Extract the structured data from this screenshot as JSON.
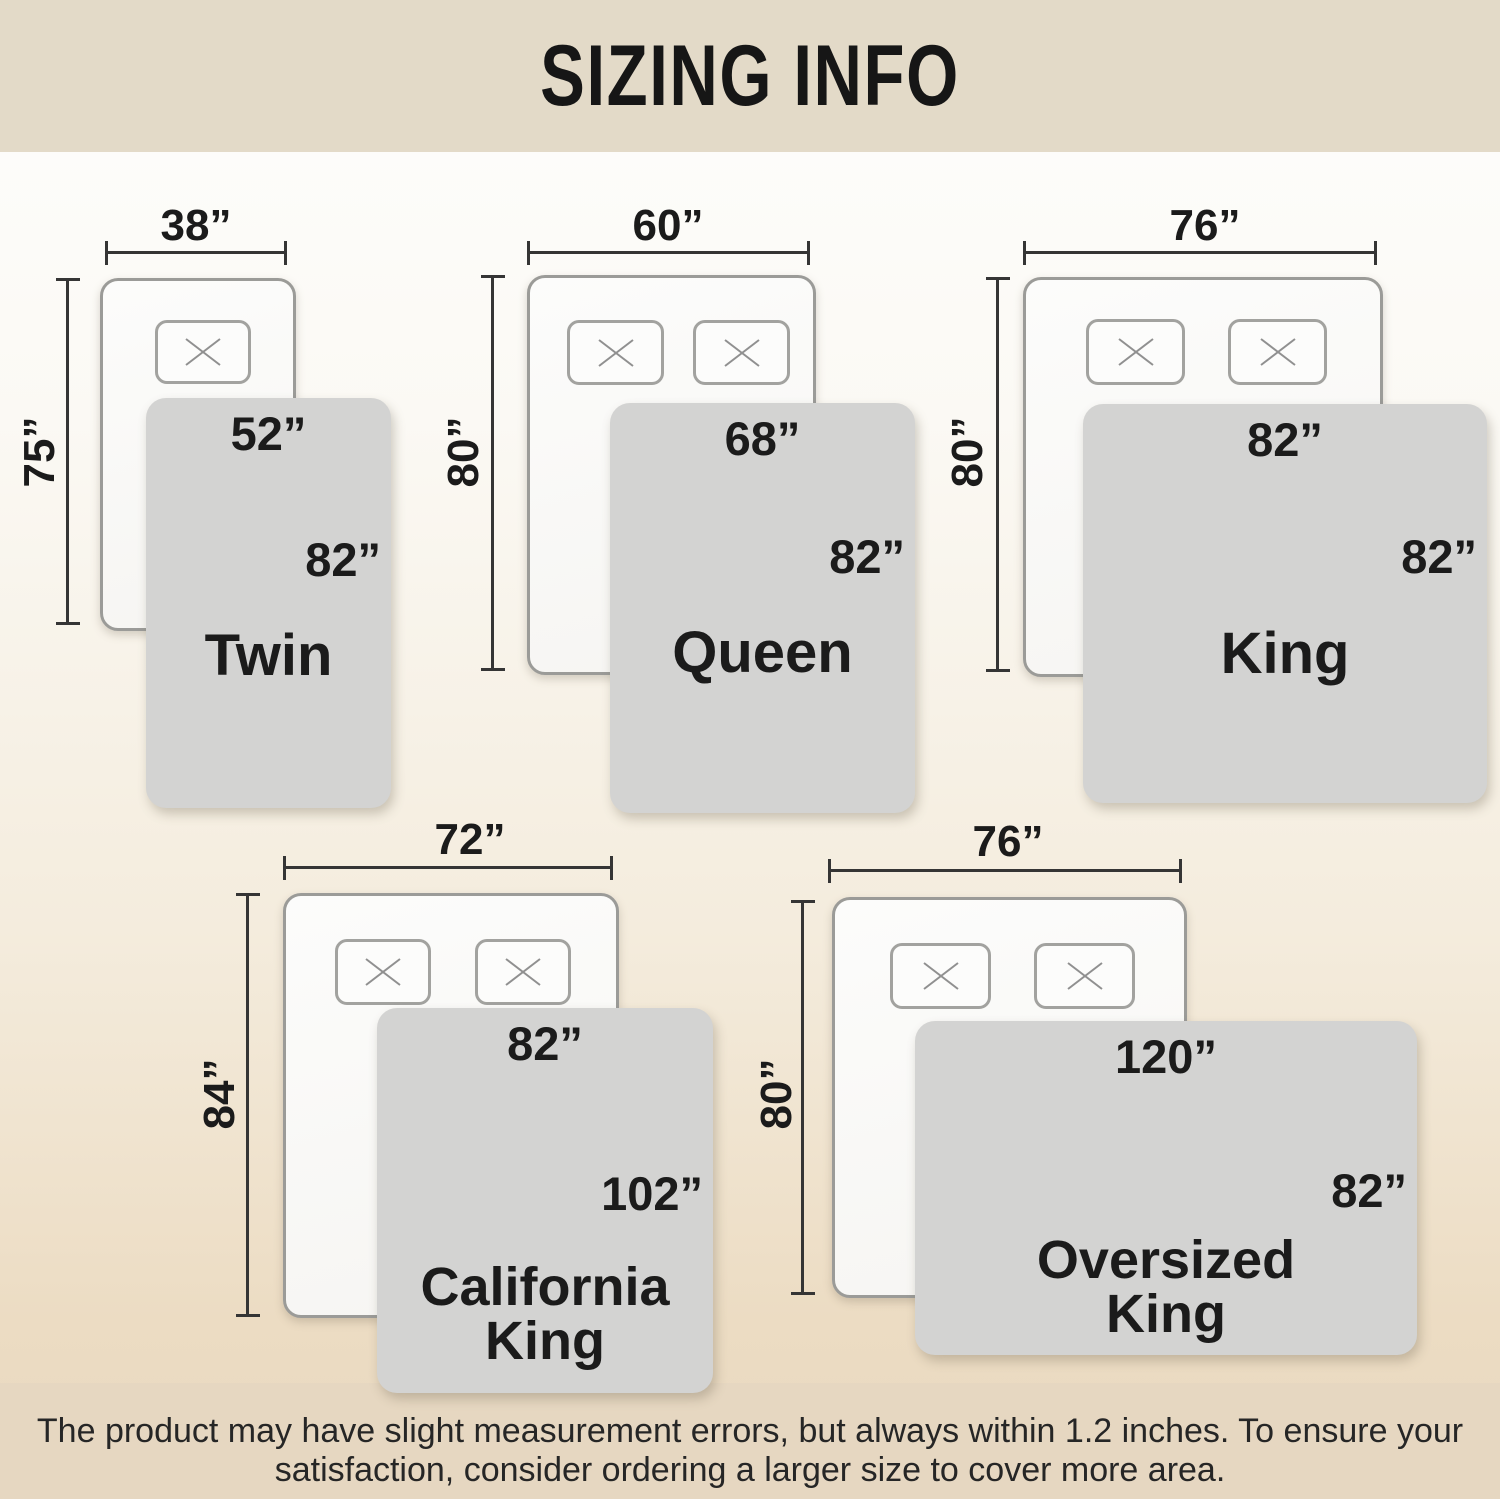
{
  "banner": {
    "title": "SIZING INFO"
  },
  "sizes": [
    {
      "name_lines": [
        "Twin"
      ],
      "bed_width": "38”",
      "bed_length": "75”",
      "blanket_width": "52”",
      "blanket_length": "82”"
    },
    {
      "name_lines": [
        "Queen"
      ],
      "bed_width": "60”",
      "bed_length": "80”",
      "blanket_width": "68”",
      "blanket_length": "82”"
    },
    {
      "name_lines": [
        "King"
      ],
      "bed_width": "76”",
      "bed_length": "80”",
      "blanket_width": "82”",
      "blanket_length": "82”"
    },
    {
      "name_lines": [
        "California",
        "King"
      ],
      "bed_width": "72”",
      "bed_length": "84”",
      "blanket_width": "82”",
      "blanket_length": "102”"
    },
    {
      "name_lines": [
        "Oversized",
        "King"
      ],
      "bed_width": "76”",
      "bed_length": "80”",
      "blanket_width": "120”",
      "blanket_length": "82”"
    }
  ],
  "footer": {
    "line1": "The product may have slight measurement errors, but always within 1.2 inches. To ensure your",
    "line2": "satisfaction, consider ordering a larger size to cover more area."
  },
  "colors": {
    "banner_bg": "#e3dac8",
    "footer_bg": "#e6d7c1",
    "blanket_fill": "#d3d3d2",
    "text": "#1b1b1b"
  }
}
